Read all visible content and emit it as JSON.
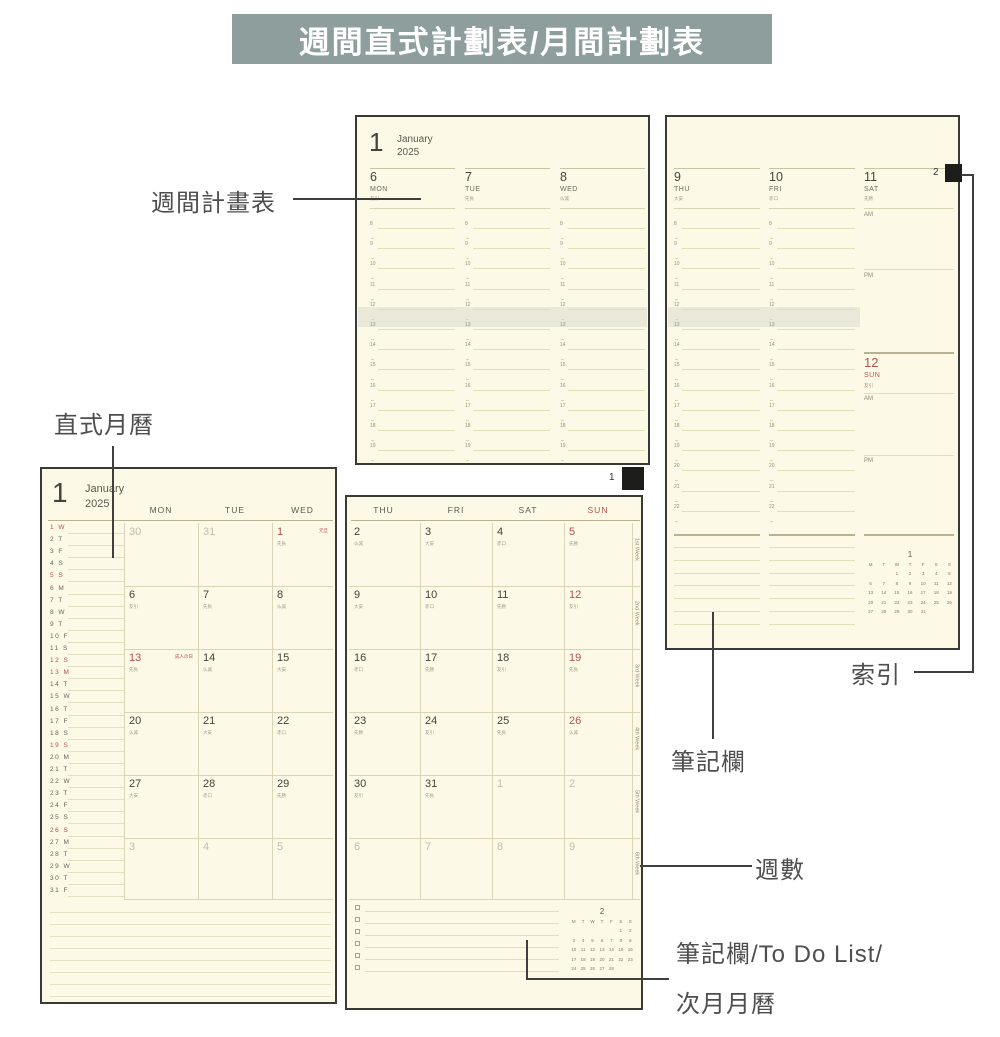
{
  "banner": {
    "title": "週間直式計劃表/月間計劃表"
  },
  "callouts": {
    "weekly": "週間計畫表",
    "monthly": "直式月曆",
    "index": "索引",
    "notes": "筆記欄",
    "week_number": "週數",
    "todo_line1": "筆記欄/To Do List/",
    "todo_line2": "次月月曆"
  },
  "colors": {
    "banner_bg": "#8d9e9c",
    "paper": "#fcf9e7",
    "page_border": "#3a3a35",
    "grid_line": "#d9d5b6",
    "red": "#b5524e",
    "ink": "#45433a",
    "muted_date": "#c2bda6",
    "tab_marker": "#1d1d1b"
  },
  "weekly": {
    "month_num": "1",
    "month_name": "January",
    "year": "2025",
    "left_days": [
      {
        "num": "6",
        "dow": "MON",
        "rokuyo": "友引"
      },
      {
        "num": "7",
        "dow": "TUE",
        "rokuyo": "先負"
      },
      {
        "num": "8",
        "dow": "WED",
        "rokuyo": "仏滅"
      }
    ],
    "right_days": [
      {
        "num": "9",
        "dow": "THU",
        "rokuyo": "大安"
      },
      {
        "num": "10",
        "dow": "FRI",
        "rokuyo": "赤口"
      },
      {
        "num": "11",
        "dow": "SAT",
        "rokuyo": "先勝"
      }
    ],
    "sun": {
      "num": "12",
      "dow": "SUN",
      "rokuyo": "友引"
    },
    "am_label": "AM",
    "pm_label": "PM",
    "hours_left": [
      "8",
      "9",
      "10",
      "11",
      "12",
      "13",
      "14",
      "15",
      "16",
      "17",
      "18",
      "19"
    ],
    "hours_right": [
      "8",
      "9",
      "10",
      "11",
      "12",
      "13",
      "14",
      "15",
      "16",
      "17",
      "18",
      "19",
      "20",
      "21",
      "22"
    ],
    "page_tabs": {
      "left": "1",
      "right": "2"
    },
    "mini_calendar": {
      "title": "1",
      "header": [
        "M",
        "T",
        "W",
        "T",
        "F",
        "S",
        "S"
      ],
      "weeks": [
        [
          "",
          "",
          "1",
          "2",
          "3",
          "4",
          "5"
        ],
        [
          "6",
          "7",
          "8",
          "9",
          "10",
          "11",
          "12"
        ],
        [
          "13",
          "14",
          "15",
          "16",
          "17",
          "18",
          "19"
        ],
        [
          "20",
          "21",
          "22",
          "23",
          "24",
          "25",
          "26"
        ],
        [
          "27",
          "28",
          "29",
          "30",
          "31",
          "",
          ""
        ]
      ]
    }
  },
  "monthly": {
    "month_num": "1",
    "month_name": "January",
    "year": "2025",
    "dow_left": [
      "MON",
      "TUE",
      "WED"
    ],
    "dow_right": [
      "THU",
      "FRI",
      "SAT",
      "SUN"
    ],
    "side_list": [
      {
        "d": "1",
        "w": "W",
        "red": true
      },
      {
        "d": "2",
        "w": "T",
        "red": false
      },
      {
        "d": "3",
        "w": "F",
        "red": false
      },
      {
        "d": "4",
        "w": "S",
        "red": false
      },
      {
        "d": "5",
        "w": "S",
        "red": true
      },
      {
        "d": "6",
        "w": "M",
        "red": false
      },
      {
        "d": "7",
        "w": "T",
        "red": false
      },
      {
        "d": "8",
        "w": "W",
        "red": false
      },
      {
        "d": "9",
        "w": "T",
        "red": false
      },
      {
        "d": "10",
        "w": "F",
        "red": false
      },
      {
        "d": "11",
        "w": "S",
        "red": false
      },
      {
        "d": "12",
        "w": "S",
        "red": true
      },
      {
        "d": "13",
        "w": "M",
        "red": true
      },
      {
        "d": "14",
        "w": "T",
        "red": false
      },
      {
        "d": "15",
        "w": "W",
        "red": false
      },
      {
        "d": "16",
        "w": "T",
        "red": false
      },
      {
        "d": "17",
        "w": "F",
        "red": false
      },
      {
        "d": "18",
        "w": "S",
        "red": false
      },
      {
        "d": "19",
        "w": "S",
        "red": true
      },
      {
        "d": "20",
        "w": "M",
        "red": false
      },
      {
        "d": "21",
        "w": "T",
        "red": false
      },
      {
        "d": "22",
        "w": "W",
        "red": false
      },
      {
        "d": "23",
        "w": "T",
        "red": false
      },
      {
        "d": "24",
        "w": "F",
        "red": false
      },
      {
        "d": "25",
        "w": "S",
        "red": false
      },
      {
        "d": "26",
        "w": "S",
        "red": true
      },
      {
        "d": "27",
        "w": "M",
        "red": false
      },
      {
        "d": "28",
        "w": "T",
        "red": false
      },
      {
        "d": "29",
        "w": "W",
        "red": false
      },
      {
        "d": "30",
        "w": "T",
        "red": false
      },
      {
        "d": "31",
        "w": "F",
        "red": false
      }
    ],
    "weeks": [
      [
        {
          "n": "30",
          "muted": true
        },
        {
          "n": "31",
          "muted": true
        },
        {
          "n": "1",
          "red": true,
          "note": "元旦",
          "rokuyo": "先負"
        },
        {
          "n": "2",
          "rokuyo": "仏滅"
        },
        {
          "n": "3",
          "rokuyo": "大安"
        },
        {
          "n": "4",
          "rokuyo": "赤口"
        },
        {
          "n": "5",
          "red": true,
          "rokuyo": "先勝"
        }
      ],
      [
        {
          "n": "6",
          "rokuyo": "友引"
        },
        {
          "n": "7",
          "rokuyo": "先負"
        },
        {
          "n": "8",
          "rokuyo": "仏滅"
        },
        {
          "n": "9",
          "rokuyo": "大安"
        },
        {
          "n": "10",
          "rokuyo": "赤口"
        },
        {
          "n": "11",
          "rokuyo": "先勝"
        },
        {
          "n": "12",
          "red": true,
          "rokuyo": "友引"
        }
      ],
      [
        {
          "n": "13",
          "red": true,
          "note": "成人の日",
          "rokuyo": "先負"
        },
        {
          "n": "14",
          "rokuyo": "仏滅"
        },
        {
          "n": "15",
          "rokuyo": "大安"
        },
        {
          "n": "16",
          "rokuyo": "赤口"
        },
        {
          "n": "17",
          "rokuyo": "先勝"
        },
        {
          "n": "18",
          "rokuyo": "友引"
        },
        {
          "n": "19",
          "red": true,
          "rokuyo": "先負"
        }
      ],
      [
        {
          "n": "20",
          "rokuyo": "仏滅"
        },
        {
          "n": "21",
          "rokuyo": "大安"
        },
        {
          "n": "22",
          "rokuyo": "赤口"
        },
        {
          "n": "23",
          "rokuyo": "先勝"
        },
        {
          "n": "24",
          "rokuyo": "友引"
        },
        {
          "n": "25",
          "rokuyo": "先負"
        },
        {
          "n": "26",
          "red": true,
          "rokuyo": "仏滅"
        }
      ],
      [
        {
          "n": "27",
          "rokuyo": "大安"
        },
        {
          "n": "28",
          "rokuyo": "赤口"
        },
        {
          "n": "29",
          "rokuyo": "先勝"
        },
        {
          "n": "30",
          "rokuyo": "友引"
        },
        {
          "n": "31",
          "rokuyo": "先負"
        },
        {
          "n": "1",
          "muted": true
        },
        {
          "n": "2",
          "muted": true
        }
      ],
      [
        {
          "n": "3",
          "muted": true
        },
        {
          "n": "4",
          "muted": true
        },
        {
          "n": "5",
          "muted": true
        },
        {
          "n": "6",
          "muted": true
        },
        {
          "n": "7",
          "muted": true
        },
        {
          "n": "8",
          "muted": true
        },
        {
          "n": "9",
          "muted": true
        }
      ]
    ],
    "week_labels": [
      "1st Week",
      "2nd Week",
      "3rd Week",
      "4th Week",
      "5th Week",
      "6th Week"
    ],
    "todo_rows": 6,
    "mini_calendar": {
      "title": "2",
      "header": [
        "M",
        "T",
        "W",
        "T",
        "F",
        "S",
        "S"
      ],
      "weeks": [
        [
          "",
          "",
          "",
          "",
          "",
          "1",
          "2"
        ],
        [
          "3",
          "4",
          "5",
          "6",
          "7",
          "8",
          "9"
        ],
        [
          "10",
          "11",
          "12",
          "13",
          "14",
          "15",
          "16"
        ],
        [
          "17",
          "18",
          "19",
          "20",
          "21",
          "22",
          "23"
        ],
        [
          "24",
          "25",
          "26",
          "27",
          "28",
          "",
          ""
        ]
      ]
    }
  }
}
